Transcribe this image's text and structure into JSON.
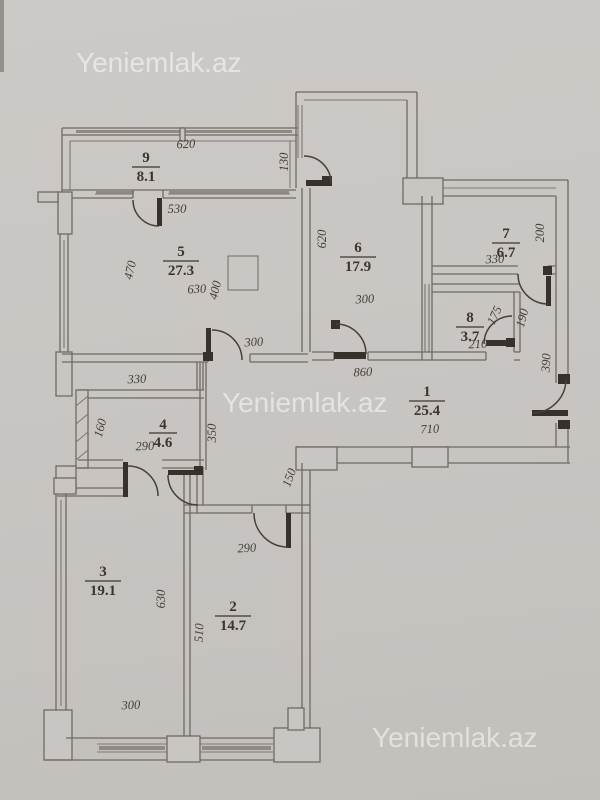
{
  "watermarks": [
    {
      "text": "Yeniemlak.az",
      "x": 76,
      "y": 72
    },
    {
      "text": "Yeniemlak.az",
      "x": 222,
      "y": 412
    },
    {
      "text": "Yeniemlak.az",
      "x": 372,
      "y": 747
    }
  ],
  "rooms": [
    {
      "number": "1",
      "area": "25.4",
      "cx": 427,
      "numY": 396,
      "lineY": 401,
      "areaY": 415
    },
    {
      "number": "2",
      "area": "14.7",
      "cx": 233,
      "numY": 611,
      "lineY": 616,
      "areaY": 630
    },
    {
      "number": "3",
      "area": "19.1",
      "cx": 103,
      "numY": 576,
      "lineY": 581,
      "areaY": 595
    },
    {
      "number": "4",
      "area": "4.6",
      "cx": 163,
      "numY": 429,
      "lineY": 433,
      "areaY": 447
    },
    {
      "number": "5",
      "area": "27.3",
      "cx": 181,
      "numY": 256,
      "lineY": 261,
      "areaY": 275
    },
    {
      "number": "6",
      "area": "17.9",
      "cx": 358,
      "numY": 252,
      "lineY": 257,
      "areaY": 271
    },
    {
      "number": "7",
      "area": "6.7",
      "cx": 506,
      "numY": 238,
      "lineY": 243,
      "areaY": 257
    },
    {
      "number": "8",
      "area": "3.7",
      "cx": 470,
      "numY": 322,
      "lineY": 327,
      "areaY": 341
    },
    {
      "number": "9",
      "area": "8.1",
      "cx": 146,
      "numY": 162,
      "lineY": 167,
      "areaY": 181
    }
  ],
  "dimensions": [
    {
      "text": "620",
      "x": 186,
      "y": 148,
      "rot": -2
    },
    {
      "text": "130",
      "x": 288,
      "y": 162,
      "rot": -90
    },
    {
      "text": "530",
      "x": 177,
      "y": 213,
      "rot": 0
    },
    {
      "text": "470",
      "x": 134,
      "y": 271,
      "rot": -77
    },
    {
      "text": "630",
      "x": 197,
      "y": 293,
      "rot": -3
    },
    {
      "text": "400",
      "x": 219,
      "y": 291,
      "rot": -77
    },
    {
      "text": "300",
      "x": 254,
      "y": 346,
      "rot": -3
    },
    {
      "text": "620",
      "x": 326,
      "y": 239,
      "rot": -90
    },
    {
      "text": "300",
      "x": 365,
      "y": 303,
      "rot": -3
    },
    {
      "text": "200",
      "x": 544,
      "y": 233,
      "rot": -90
    },
    {
      "text": "330",
      "x": 495,
      "y": 263,
      "rot": -2
    },
    {
      "text": "175",
      "x": 498,
      "y": 317,
      "rot": -65
    },
    {
      "text": "190",
      "x": 526,
      "y": 319,
      "rot": -75
    },
    {
      "text": "210",
      "x": 478,
      "y": 348,
      "rot": -2
    },
    {
      "text": "390",
      "x": 550,
      "y": 363,
      "rot": -87
    },
    {
      "text": "860",
      "x": 363,
      "y": 376,
      "rot": -2
    },
    {
      "text": "710",
      "x": 430,
      "y": 433,
      "rot": -3
    },
    {
      "text": "350",
      "x": 216,
      "y": 433,
      "rot": -90
    },
    {
      "text": "330",
      "x": 137,
      "y": 383,
      "rot": -2
    },
    {
      "text": "160",
      "x": 104,
      "y": 429,
      "rot": -75
    },
    {
      "text": "290",
      "x": 145,
      "y": 450,
      "rot": -2
    },
    {
      "text": "150",
      "x": 293,
      "y": 479,
      "rot": -70
    },
    {
      "text": "290",
      "x": 247,
      "y": 552,
      "rot": -3
    },
    {
      "text": "510",
      "x": 203,
      "y": 633,
      "rot": -87
    },
    {
      "text": "630",
      "x": 165,
      "y": 599,
      "rot": -90
    },
    {
      "text": "300",
      "x": 131,
      "y": 709,
      "rot": -2
    }
  ],
  "colors": {
    "paper": "#c9c5c2",
    "wall_line": "#6e6a62",
    "door_dark": "#36322b",
    "label_text": "#3a362f",
    "watermark": "rgba(255,255,255,0.52)"
  }
}
